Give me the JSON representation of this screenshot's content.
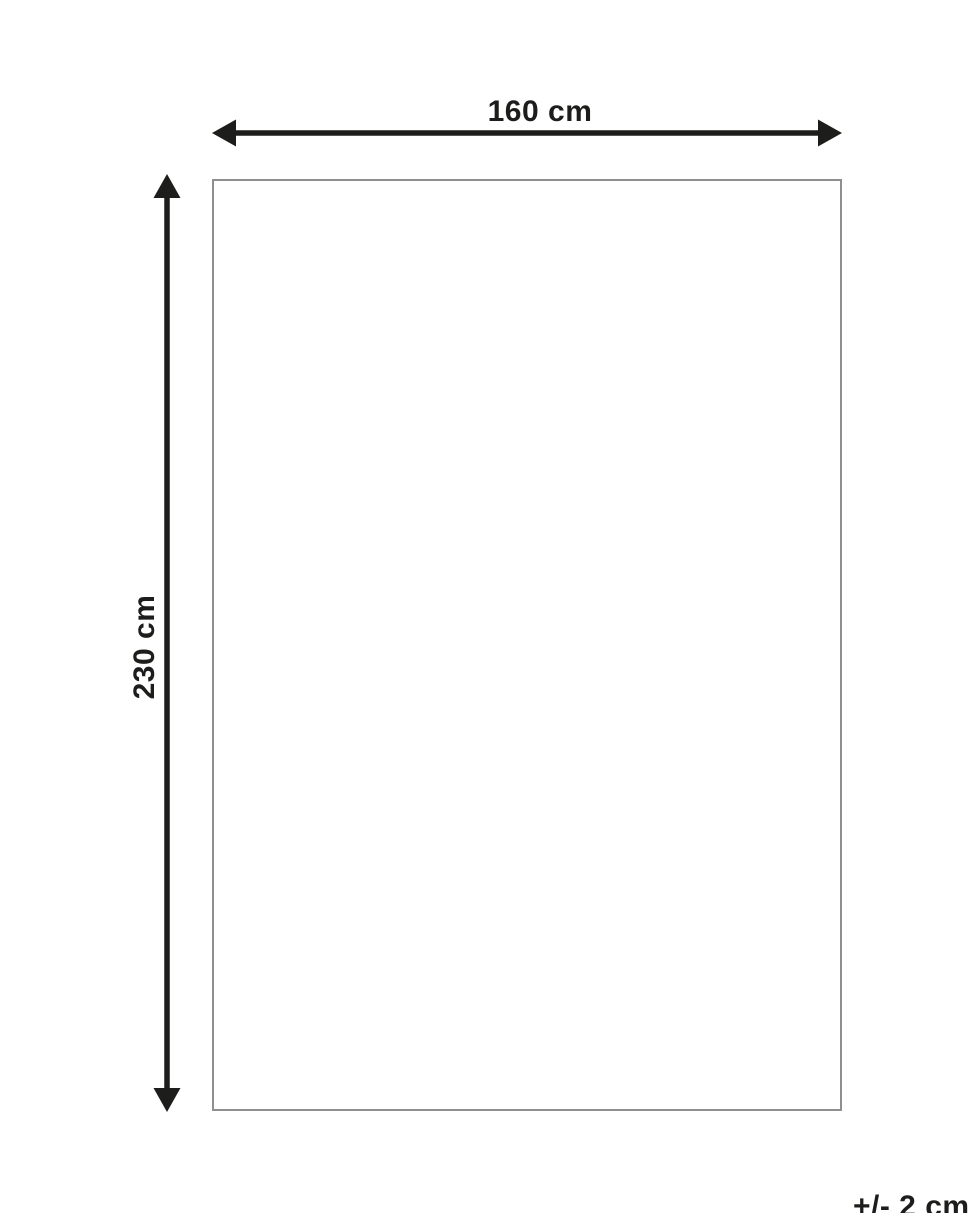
{
  "diagram": {
    "width_label": "160 cm",
    "height_label": "230 cm",
    "tolerance_label": "+/- 2 cm",
    "colors": {
      "arrow": "#1d1d1b",
      "label_text": "#1d1d1b",
      "rectangle_outline": "#8f8f8f",
      "background": "#ffffff"
    }
  }
}
